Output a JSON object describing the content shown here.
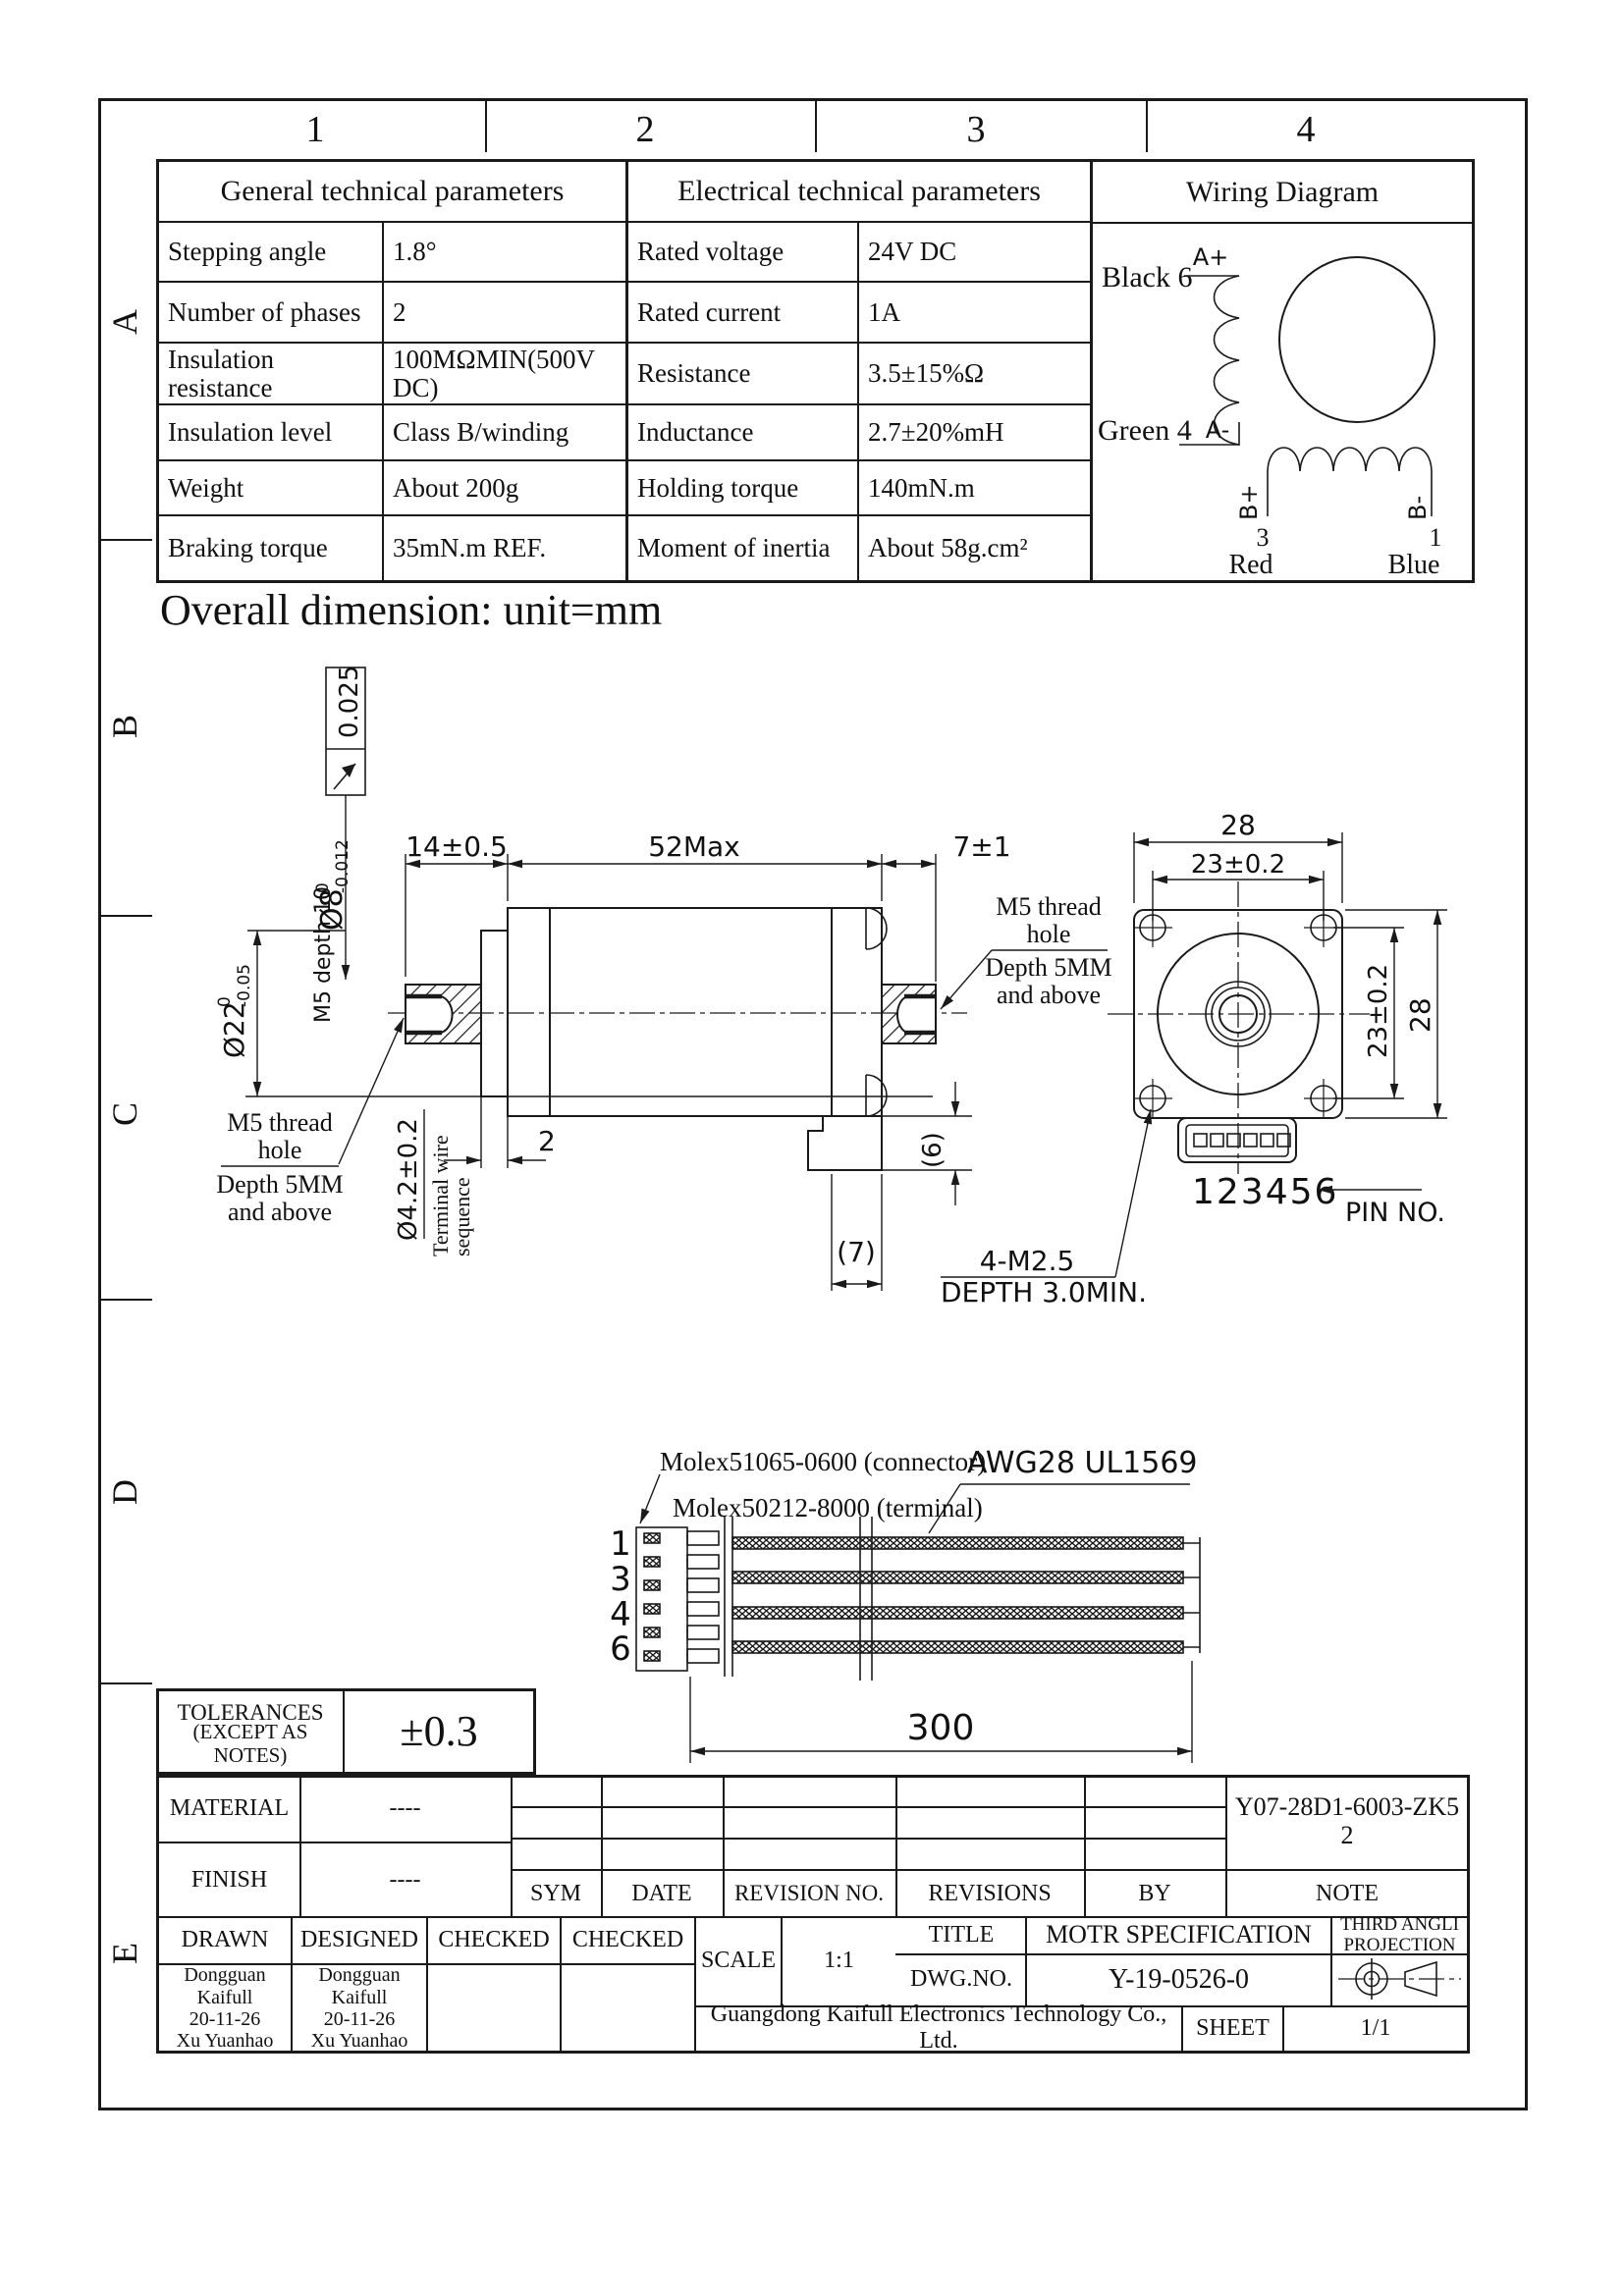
{
  "page": {
    "ink": "#1a1a1a",
    "bg": "#ffffff"
  },
  "frame": {
    "columns": [
      "1",
      "2",
      "3",
      "4"
    ],
    "rows": [
      "A",
      "B",
      "C",
      "D",
      "E"
    ]
  },
  "tables": {
    "general": {
      "title": "General technical parameters",
      "rows": [
        {
          "label": "Stepping angle",
          "value": "1.8°"
        },
        {
          "label": "Number of phases",
          "value": "2"
        },
        {
          "label": "Insulation resistance",
          "value": "100MΩMIN(500V DC)"
        },
        {
          "label": "Insulation level",
          "value": "Class B/winding"
        },
        {
          "label": "Weight",
          "value": "About 200g"
        },
        {
          "label": "Braking torque",
          "value": "35mN.m REF."
        }
      ]
    },
    "electrical": {
      "title": "Electrical technical parameters",
      "rows": [
        {
          "label": "Rated voltage",
          "value": "24V DC"
        },
        {
          "label": "Rated current",
          "value": "1A"
        },
        {
          "label": "Resistance",
          "value": "3.5±15%Ω"
        },
        {
          "label": "Inductance",
          "value": "2.7±20%mH"
        },
        {
          "label": "Holding torque",
          "value": "140mN.m"
        },
        {
          "label": "Moment of inertia",
          "value": "About 58g.cm²"
        }
      ]
    },
    "wiring": {
      "title": "Wiring Diagram",
      "black": "Black 6",
      "a_plus": "A+",
      "green": "Green 4",
      "a_minus": "A-",
      "b_plus": "B+",
      "b_minus": "B-",
      "pin3": "3",
      "red": "Red",
      "pin1": "1",
      "blue": "Blue"
    }
  },
  "section_title": "Overall dimension: unit=mm",
  "side": {
    "dim14": "14±0.5",
    "dim52": "52Max",
    "dim7": "7±1",
    "runout": "0.025",
    "d8_main": "Ø8",
    "d8_top": "0",
    "d8_bot": "-0.012",
    "m5_depth": "M5 depth 10",
    "d22_main": "Ø22",
    "d22_top": "0",
    "d22_bot": "-0.05",
    "d42": "Ø4.2±0.2",
    "wire_seq1": "Terminal wire",
    "wire_seq2": "sequence",
    "dim2": "2",
    "dim6": "(6)",
    "dim7b": "(7)",
    "m5_hole_1": "M5 thread",
    "m5_hole_2": "hole",
    "m5_hole_3": "Depth 5MM",
    "m5_hole_4": "and above",
    "m25_1": "4-M2.5",
    "m25_2": "DEPTH 3.0MIN."
  },
  "front": {
    "w28": "28",
    "w23": "23±0.2",
    "h23": "23±0.2",
    "h28": "28",
    "pin_row": "123456",
    "pin_no": "PIN NO."
  },
  "cable": {
    "connector": "Molex51065-0600 (connector)",
    "terminal": "Molex50212-8000 (terminal)",
    "awg": "AWG28 UL1569",
    "pins": [
      "1",
      "3",
      "4",
      "6"
    ],
    "length": "300"
  },
  "title_block": {
    "tol1": "TOLERANCES",
    "tol2": "(EXCEPT AS NOTES)",
    "tol_value": "±0.3",
    "material_label": "MATERIAL",
    "material_value": "----",
    "finish_label": "FINISH",
    "finish_value": "----",
    "sym": "SYM",
    "date": "DATE",
    "revision_no": "REVISION NO.",
    "revisions": "REVISIONS",
    "by": "BY",
    "note": "NOTE",
    "drawn": "DRAWN",
    "designed": "DESIGNED",
    "checked1": "CHECKED",
    "checked2": "CHECKED",
    "drawn_person": "Dongguan\nKaifull\n20-11-26\nXu Yuanhao",
    "designed_person": "Dongguan\nKaifull\n20-11-26\nXu Yuanhao",
    "scale_label": "SCALE",
    "scale_value": "1:1",
    "title_label": "TITLE",
    "title_value": "MOTR SPECIFICATION",
    "projection": "THIRD ANGLI\nPROJECTION",
    "dwg_label": "DWG.NO.",
    "dwg_value": "Y-19-0526-0",
    "part_no": "Y07-28D1-6003-ZK5\n2",
    "company": "Guangdong Kaifull Electronics Technology Co., Ltd.",
    "sheet_label": "SHEET",
    "sheet_value": "1/1"
  }
}
